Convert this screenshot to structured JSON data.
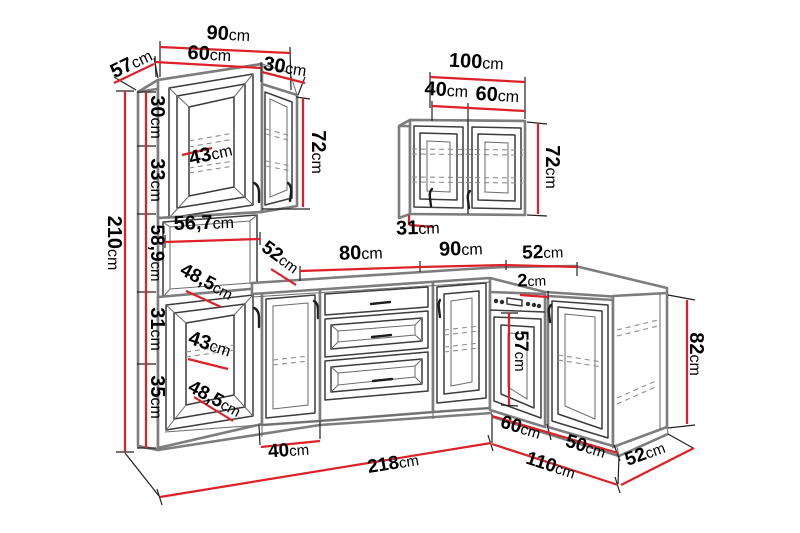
{
  "diagram": {
    "background": "#ffffff",
    "unit": "cm",
    "colors": {
      "dimension": "#dd2127",
      "label_text": "#000000",
      "outline_strong": "#7d7d7d",
      "outline": "#3c3c3c",
      "dashed": "#909090"
    },
    "dimension_labels": [
      {
        "id": "top-width-90",
        "value": "90",
        "unit": "cm",
        "x": 228,
        "y": 40,
        "rotate": 3,
        "size": 20
      },
      {
        "id": "top-width-60",
        "value": "60",
        "unit": "cm",
        "x": 209,
        "y": 60,
        "rotate": 3,
        "size": 20
      },
      {
        "id": "top-width-30",
        "value": "30",
        "unit": "cm",
        "x": 284,
        "y": 73,
        "rotate": 9,
        "size": 20
      },
      {
        "id": "depth-57",
        "value": "57",
        "unit": "cm",
        "x": 134,
        "y": 69,
        "rotate": -26,
        "size": 20
      },
      {
        "id": "segment-30",
        "value": "30",
        "unit": "cm",
        "x": 151,
        "y": 117,
        "rotate": 90,
        "size": 20
      },
      {
        "id": "segment-33",
        "value": "33",
        "unit": "cm",
        "x": 151,
        "y": 180,
        "rotate": 90,
        "size": 20
      },
      {
        "id": "segment-58-9",
        "value": "58,9",
        "unit": "cm",
        "x": 151,
        "y": 253,
        "rotate": 90,
        "size": 19
      },
      {
        "id": "segment-31",
        "value": "31",
        "unit": "cm",
        "x": 151,
        "y": 329,
        "rotate": 90,
        "size": 20
      },
      {
        "id": "segment-35",
        "value": "35",
        "unit": "cm",
        "x": 151,
        "y": 397,
        "rotate": 90,
        "size": 20
      },
      {
        "id": "height-210",
        "value": "210",
        "unit": "cm",
        "x": 108,
        "y": 243,
        "rotate": 90,
        "size": 20
      },
      {
        "id": "interior-43-top",
        "value": "43",
        "unit": "cm",
        "x": 212,
        "y": 160,
        "rotate": -13,
        "size": 20
      },
      {
        "id": "height-72-left",
        "value": "72",
        "unit": "cm",
        "x": 312,
        "y": 152,
        "rotate": 90,
        "size": 20
      },
      {
        "id": "interior-56-7",
        "value": "56,7",
        "unit": "cm",
        "x": 204,
        "y": 229,
        "rotate": -2,
        "size": 20
      },
      {
        "id": "interior-48-5-upper",
        "value": "48,5",
        "unit": "cm",
        "x": 204,
        "y": 287,
        "rotate": 28,
        "size": 19
      },
      {
        "id": "depth-52-left",
        "value": "52",
        "unit": "cm",
        "x": 277,
        "y": 262,
        "rotate": 36,
        "size": 19
      },
      {
        "id": "interior-43-base",
        "value": "43",
        "unit": "cm",
        "x": 208,
        "y": 350,
        "rotate": 18,
        "size": 20
      },
      {
        "id": "interior-48-5-lower",
        "value": "48,5",
        "unit": "cm",
        "x": 212,
        "y": 404,
        "rotate": 28,
        "size": 19
      },
      {
        "id": "width-40-base",
        "value": "40",
        "unit": "cm",
        "x": 289,
        "y": 456,
        "rotate": -4,
        "size": 19
      },
      {
        "id": "width-218",
        "value": "218",
        "unit": "cm",
        "x": 394,
        "y": 469,
        "rotate": -9,
        "size": 19
      },
      {
        "id": "wall-width-100",
        "value": "100",
        "unit": "cm",
        "x": 476,
        "y": 68,
        "rotate": 3,
        "size": 20
      },
      {
        "id": "wall-width-40",
        "value": "40",
        "unit": "cm",
        "x": 446,
        "y": 96,
        "rotate": 3,
        "size": 20
      },
      {
        "id": "wall-width-60",
        "value": "60",
        "unit": "cm",
        "x": 497,
        "y": 101,
        "rotate": 3,
        "size": 20
      },
      {
        "id": "wall-height-72",
        "value": "72",
        "unit": "cm",
        "x": 546,
        "y": 167,
        "rotate": 90,
        "size": 20
      },
      {
        "id": "wall-depth-31",
        "value": "31",
        "unit": "cm",
        "x": 418,
        "y": 234,
        "rotate": -2,
        "size": 20
      },
      {
        "id": "counter-80",
        "value": "80",
        "unit": "cm",
        "x": 361,
        "y": 259,
        "rotate": -2,
        "size": 20
      },
      {
        "id": "counter-90",
        "value": "90",
        "unit": "cm",
        "x": 461,
        "y": 255,
        "rotate": -2,
        "size": 20
      },
      {
        "id": "counter-52",
        "value": "52",
        "unit": "cm",
        "x": 543,
        "y": 258,
        "rotate": -2,
        "size": 19
      },
      {
        "id": "gap-2",
        "value": "2",
        "unit": "cm",
        "x": 532,
        "y": 286,
        "rotate": -2,
        "size": 18
      },
      {
        "id": "oven-57",
        "value": "57",
        "unit": "cm",
        "x": 515,
        "y": 351,
        "rotate": 90,
        "size": 19
      },
      {
        "id": "height-82",
        "value": "82",
        "unit": "cm",
        "x": 690,
        "y": 354,
        "rotate": 90,
        "size": 20
      },
      {
        "id": "bottom-60",
        "value": "60",
        "unit": "cm",
        "x": 519,
        "y": 433,
        "rotate": 17,
        "size": 19
      },
      {
        "id": "bottom-50",
        "value": "50",
        "unit": "cm",
        "x": 584,
        "y": 452,
        "rotate": 17,
        "size": 19
      },
      {
        "id": "bottom-52",
        "value": "52",
        "unit": "cm",
        "x": 647,
        "y": 459,
        "rotate": -20,
        "size": 19
      },
      {
        "id": "bottom-110",
        "value": "110",
        "unit": "cm",
        "x": 549,
        "y": 471,
        "rotate": 18,
        "size": 19
      }
    ],
    "dimension_lines": [
      {
        "id": "top-90",
        "x1": 160,
        "y1": 47,
        "x2": 290,
        "y2": 53
      },
      {
        "id": "top-60",
        "x1": 155,
        "y1": 62,
        "x2": 261,
        "y2": 68
      },
      {
        "id": "top-30",
        "x1": 262,
        "y1": 72,
        "x2": 305,
        "y2": 83
      },
      {
        "id": "depth-57",
        "x1": 114,
        "y1": 83,
        "x2": 154,
        "y2": 64
      },
      {
        "id": "left-stack",
        "x1": 146,
        "y1": 92,
        "x2": 146,
        "y2": 448
      },
      {
        "id": "height-210",
        "x1": 125,
        "y1": 91,
        "x2": 125,
        "y2": 452
      },
      {
        "id": "interior-43-top",
        "x1": 182,
        "y1": 155,
        "x2": 212,
        "y2": 148
      },
      {
        "id": "height-72-left",
        "x1": 303,
        "y1": 98,
        "x2": 303,
        "y2": 207
      },
      {
        "id": "interior-56-7",
        "x1": 165,
        "y1": 242,
        "x2": 260,
        "y2": 239
      },
      {
        "id": "interior-48-5-upper",
        "x1": 186,
        "y1": 291,
        "x2": 221,
        "y2": 307
      },
      {
        "id": "depth-52-left",
        "x1": 271,
        "y1": 269,
        "x2": 296,
        "y2": 285
      },
      {
        "id": "interior-43-base",
        "x1": 188,
        "y1": 359,
        "x2": 228,
        "y2": 369
      },
      {
        "id": "interior-48-5-lower",
        "x1": 194,
        "y1": 397,
        "x2": 233,
        "y2": 421
      },
      {
        "id": "width-40-base",
        "x1": 261,
        "y1": 447,
        "x2": 320,
        "y2": 441
      },
      {
        "id": "width-218",
        "x1": 160,
        "y1": 497,
        "x2": 491,
        "y2": 443
      },
      {
        "id": "wall-width-100",
        "x1": 430,
        "y1": 77,
        "x2": 525,
        "y2": 82
      },
      {
        "id": "wall-width-40-60",
        "x1": 432,
        "y1": 106,
        "x2": 525,
        "y2": 111
      },
      {
        "id": "wall-height-72",
        "x1": 538,
        "y1": 123,
        "x2": 538,
        "y2": 214
      },
      {
        "id": "wall-depth-31-a",
        "x1": 409,
        "y1": 215,
        "x2": 409,
        "y2": 225
      },
      {
        "id": "wall-depth-31-b",
        "x1": 409,
        "y1": 225,
        "x2": 434,
        "y2": 227
      },
      {
        "id": "counter-80",
        "x1": 300,
        "y1": 271,
        "x2": 420,
        "y2": 267
      },
      {
        "id": "counter-90",
        "x1": 420,
        "y1": 267,
        "x2": 506,
        "y2": 265
      },
      {
        "id": "counter-52",
        "x1": 506,
        "y1": 265,
        "x2": 577,
        "y2": 267
      },
      {
        "id": "gap-2",
        "x1": 520,
        "y1": 295,
        "x2": 548,
        "y2": 297
      },
      {
        "id": "oven-57",
        "x1": 509,
        "y1": 313,
        "x2": 509,
        "y2": 405
      },
      {
        "id": "height-82",
        "x1": 687,
        "y1": 300,
        "x2": 687,
        "y2": 424
      },
      {
        "id": "bottom-60-50",
        "x1": 492,
        "y1": 416,
        "x2": 618,
        "y2": 453
      },
      {
        "id": "bottom-52",
        "x1": 621,
        "y1": 485,
        "x2": 694,
        "y2": 448
      },
      {
        "id": "bottom-110",
        "x1": 492,
        "y1": 444,
        "x2": 618,
        "y2": 485
      }
    ]
  }
}
